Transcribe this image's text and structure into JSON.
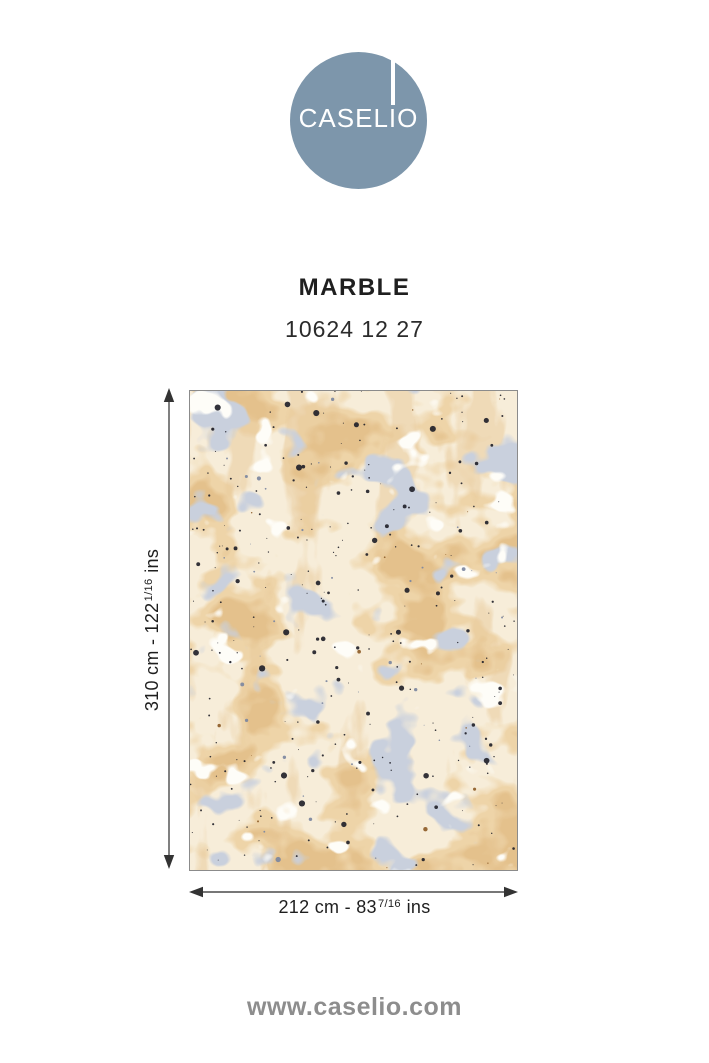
{
  "brand": {
    "logo_text": "CASELIO",
    "logo_circle_color": "#7d96ab",
    "website": "www.caselio.com"
  },
  "product": {
    "name": "MARBLE",
    "reference": "10624 12 27"
  },
  "dimensions": {
    "height": {
      "main": "310 cm - 122",
      "fraction": "1/16",
      "unit": "ins"
    },
    "width": {
      "main": "212 cm - 83",
      "fraction": "7/16",
      "unit": "ins"
    }
  },
  "swatch_colors": {
    "base": "#f7edd9",
    "tan_light": "#eed4a8",
    "tan_deep": "#e4c18c",
    "tan_streak": "#e9cb9d",
    "blue_gray": "#c9d0dd",
    "white_patch": "#fefdf8",
    "speckle_dark": "#22222a",
    "speckle_blue": "#7c87a0",
    "speckle_brown": "#8d5c28"
  }
}
